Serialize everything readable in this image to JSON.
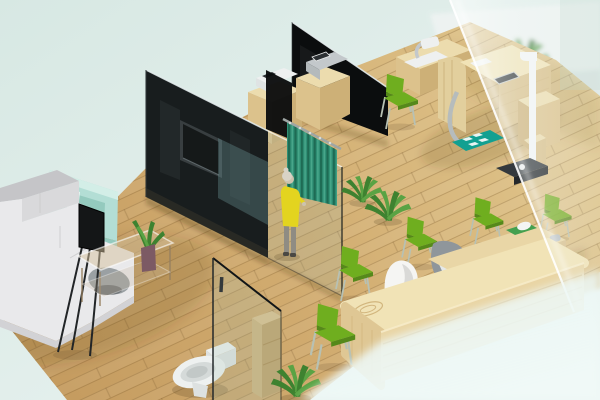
{
  "scene": {
    "title": "3D isometric interior render of a clinic office with waiting area, consultation cubicles, exam station, reception desk and toilet room",
    "style": "isometric-3d-render",
    "visible_text": []
  },
  "objects": [
    {
      "id": "sectional-sofa",
      "label": "White sectional sofa with grey back cushions"
    },
    {
      "id": "accent-armchair",
      "label": "Mint accent armchair"
    },
    {
      "id": "display-easel",
      "label": "Black display screen on tripod stand"
    },
    {
      "id": "coffee-table",
      "label": "Glass coffee table with potted plant"
    },
    {
      "id": "tv-partition-wall",
      "label": "Black partition wall with mounted TV"
    },
    {
      "id": "back-partition-wall",
      "label": "Second black partition wall"
    },
    {
      "id": "glass-partitions",
      "label": "Tinted glass partition panels"
    },
    {
      "id": "privacy-curtain",
      "label": "Teal privacy curtain on rail"
    },
    {
      "id": "standing-person",
      "label": "Woman in yellow dress standing at curtain"
    },
    {
      "id": "consultation-cabinets",
      "label": "Wooden cabinets with white and grey devices"
    },
    {
      "id": "exam-station",
      "label": "Wooden examination station with tablet, chrome tube and teal mat"
    },
    {
      "id": "height-scale",
      "label": "Height rod with weighing scale"
    },
    {
      "id": "reception-desk",
      "label": "Curved light-wood reception desk"
    },
    {
      "id": "cocoon-chair",
      "label": "White cocoon chair"
    },
    {
      "id": "office-chair",
      "label": "Grey office chair"
    },
    {
      "id": "visitor-chairs",
      "label": "Green visitor chairs"
    },
    {
      "id": "floor-plants",
      "label": "Green floor plants"
    },
    {
      "id": "toilet-room",
      "label": "Glass-walled toilet room with wooden cabinet"
    },
    {
      "id": "frosted-glass-wall",
      "label": "Frosted glass wall on the right"
    }
  ],
  "colors": {
    "bgTop": "#d7e8e3",
    "bgMid": "#e3efec",
    "bgBot": "#eef7f5",
    "floorA": "#c59c60",
    "floorB": "#d3ae72",
    "floorC": "#e0c78e",
    "plankLine": "rgba(122,88,42,0.30)",
    "plankSeam": "rgba(110,78,36,0.22)",
    "wallBlack": "#0b0d0e",
    "wallEdge": "#e6edee",
    "tvFrame": "#2e3234",
    "tvScreen": "#070808",
    "glassTint": "rgba(150,178,172,0.20)",
    "glassSmoke": "rgba(100,140,142,0.38)",
    "glassEdge": "rgba(18,24,24,0.75)",
    "glassBright": "rgba(255,255,255,0.85)",
    "curtain": "#2f8f74",
    "curtainDark": "#1e6b54",
    "curtainLight": "#49a88b",
    "rail": "#9fa6a4",
    "dressYellow": "#e3d41f",
    "skin": "#cdc3ae",
    "hair": "#d9d3c6",
    "pants": "#8f8c83",
    "shoe": "#4a4843",
    "sofaSeat": "#e9e9eb",
    "sofaBack": "#c5c5c8",
    "sofaInner": "#d9d9db",
    "sofaFront": "#d2d2d5",
    "dome": "#9aa0a3",
    "domeDark": "#6f7477",
    "armchairA": "#b3ded5",
    "armchairB": "#94cabe",
    "armchairC": "#d3eee7",
    "pillow": "#e7f7f2",
    "easel": "#141617",
    "tableGlass": "rgba(214,194,158,0.50)",
    "tableEdge": "rgba(255,255,255,0.55)",
    "tableLeg": "rgba(150,128,96,0.9)",
    "vase": "#7c5a64",
    "leafA": "#3e8230",
    "leafB": "#5aa344",
    "woodTop": "#ecdcae",
    "woodFront": "#dcc28c",
    "woodSide": "#cdb077",
    "grain": "rgba(160,120,60,0.5)",
    "deskTop": "#f1e3b6",
    "deskFront": "#e9d5a5",
    "deskEnd": "#dfc794",
    "deskGrain": "#d2b67e",
    "tierTop": "#e9d6a6",
    "tierFront": "#d8c08e",
    "tray": "#44a04f",
    "trayItem": "#f3f5f4",
    "knob": "#b9bfc2",
    "cocoon": "#f5f5f3",
    "cocoonIn": "#d9d9d7",
    "greyBack": "#8f969b",
    "greySeat": "#e6e9e9",
    "chairGreen": "#6fae1f",
    "chairGreenDark": "#55891a",
    "chairLeg": "#b7c1b4",
    "deviceWhite": "#eef0f0",
    "deviceGrey": "#c3c8cb",
    "deviceDark": "#54595c",
    "screenDark": "#2c3033",
    "chrome": "#b6bcbc",
    "mat": "#12a091",
    "matSq": "#e9f5f3",
    "pole": "#f3f5f5",
    "scaleTop": "#34393d",
    "scaleFront": "#23272a",
    "toilet": "#eef1f0",
    "toiletIn": "#d5dad9",
    "toiletIn2": "#c2c8c7",
    "toiletBase": "#dde1e0",
    "cabTop": "#dcc18d",
    "cabFront": "#cfb47e",
    "cabSide": "#c0a26a",
    "backWhite": "#eef3f2",
    "backGrey": "#ccd4d6",
    "backGrey2": "#dde6e5",
    "backChairBlue": "#a4bac6",
    "backWood": "#d3b77b",
    "backDark": "#6b7478",
    "shadow": "rgba(60,42,18,0.18)",
    "shadowSoft": "rgba(70,50,25,0.14)"
  }
}
